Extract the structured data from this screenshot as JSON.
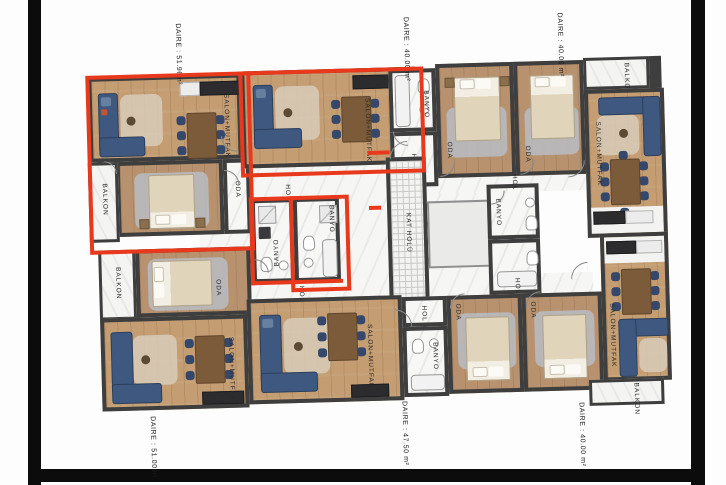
{
  "colors": {
    "highlight_red": "#e8391c",
    "wall": "#3e3e3e",
    "wood_floor": "#c49d72",
    "marble_floor": "#f6f6f4",
    "sofa_navy": "#3f5880",
    "page_frame_black": "#0c0c0c"
  },
  "apartments": [
    {
      "id": "top-left",
      "area_label": "DAIRE : 51.96m²",
      "highlighted": true
    },
    {
      "id": "top-middle",
      "area_label": "DAIRE : 40.00 m²",
      "highlighted": false
    },
    {
      "id": "top-right",
      "area_label": "DAIRE : 40.00 m²",
      "highlighted": false
    },
    {
      "id": "bottom-left",
      "area_label": "DAIRE : 51.00m²",
      "highlighted": false
    },
    {
      "id": "bottom-middle",
      "area_label": "DAIRE : 47.50 m²",
      "highlighted": false
    },
    {
      "id": "bottom-right",
      "area_label": "DAIRE : 40.00 m²",
      "highlighted": false
    }
  ],
  "room_labels": {
    "salon": "SALON+MUTFAK",
    "oda": "ODA",
    "balkon": "BALKON",
    "banyo": "BANYO",
    "hol": "HOL",
    "kat_holu": "KAT HOLÜ"
  }
}
